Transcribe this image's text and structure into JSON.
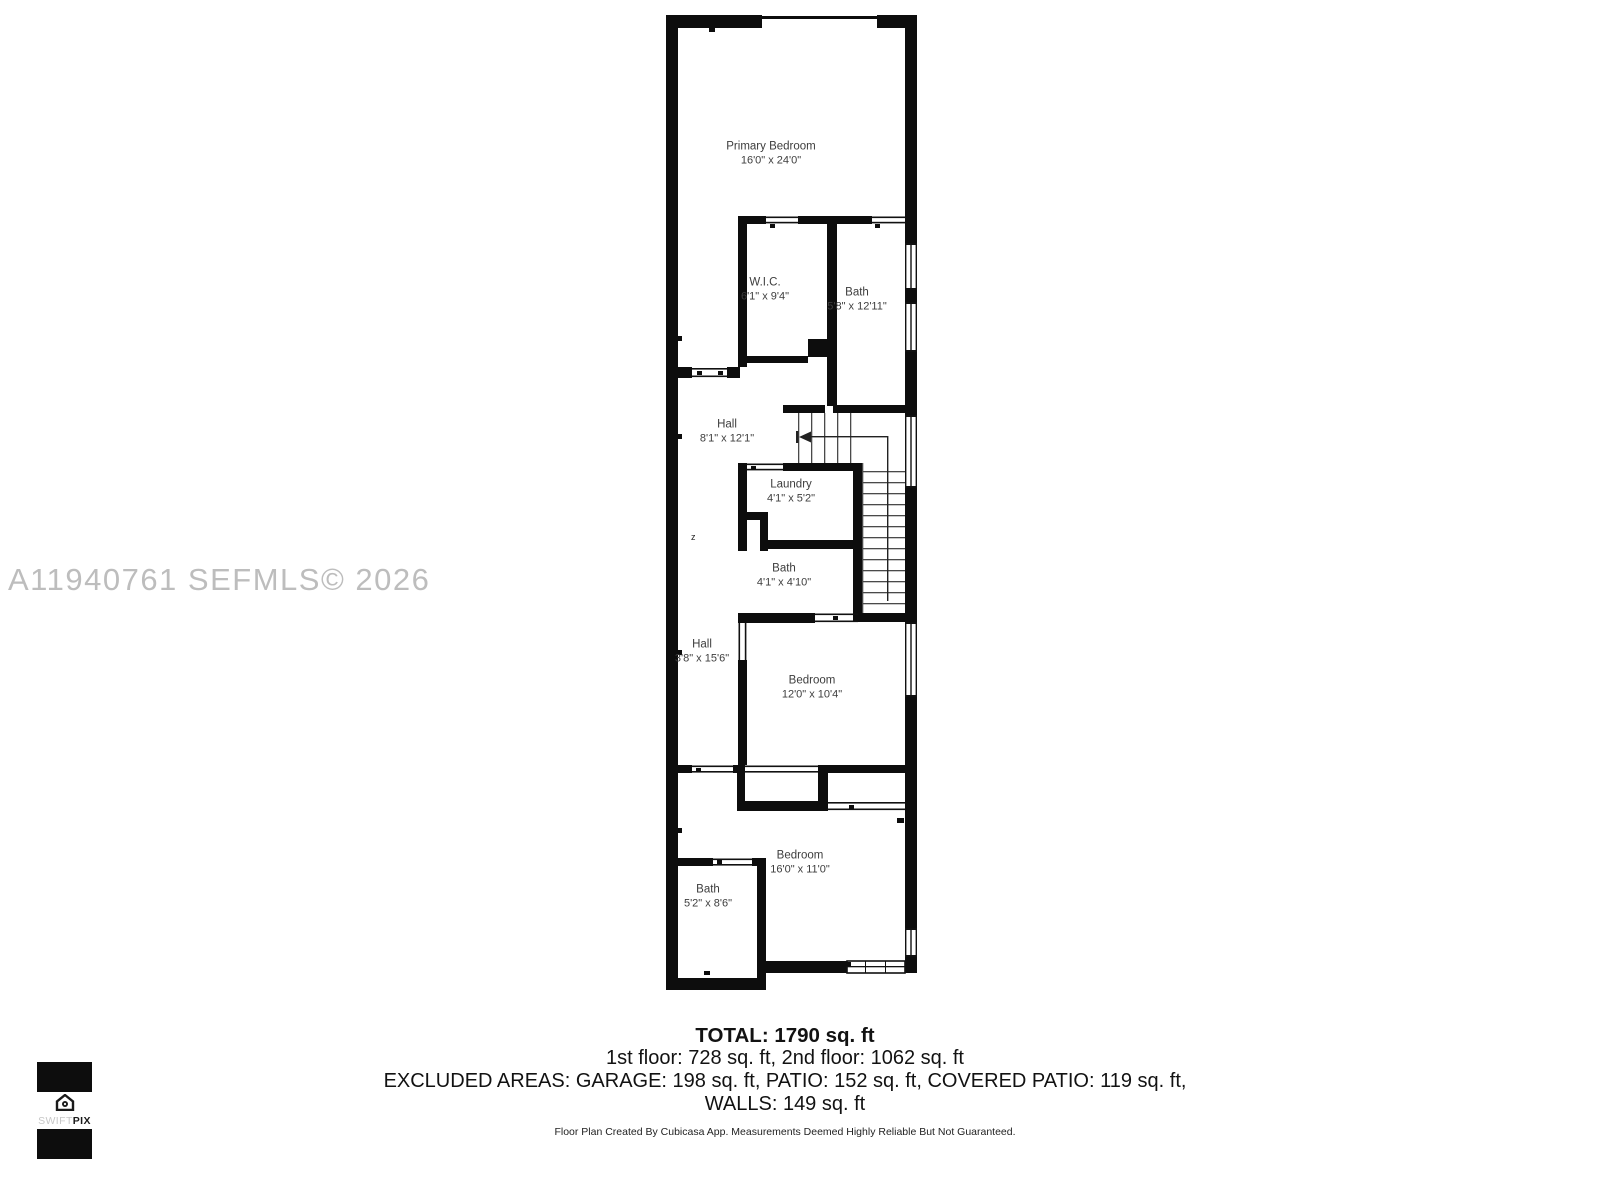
{
  "watermark": "A11940761  SEFMLS© 2026",
  "floor_plan": {
    "rooms": [
      {
        "name": "Primary Bedroom",
        "dims": "16'0\" x 24'0\""
      },
      {
        "name": "W.I.C.",
        "dims": "6'1\" x 9'4\""
      },
      {
        "name": "Bath",
        "dims": "5'8\" x 12'11\""
      },
      {
        "name": "Hall",
        "dims": "8'1\" x 12'1\""
      },
      {
        "name": "Laundry",
        "dims": "4'1\" x 5'2\""
      },
      {
        "name": "Bath",
        "dims": "4'1\" x 4'10\""
      },
      {
        "name": "Hall",
        "dims": "3'8\" x 15'6\""
      },
      {
        "name": "Bedroom",
        "dims": "12'0\" x 10'4\""
      },
      {
        "name": "Bedroom",
        "dims": "16'0\" x 11'0\""
      },
      {
        "name": "Bath",
        "dims": "5'2\" x 8'6\""
      }
    ],
    "stair_note": "z"
  },
  "summary": {
    "total": "TOTAL: 1790 sq. ft",
    "floors": "1st floor: 728 sq. ft, 2nd floor: 1062 sq. ft",
    "excluded": "EXCLUDED AREAS: GARAGE: 198 sq. ft, PATIO: 152 sq. ft, COVERED PATIO: 119 sq. ft,",
    "walls": "WALLS: 149 sq. ft",
    "disclaimer": "Floor Plan Created By Cubicasa App. Measurements Deemed Highly Reliable But Not Guaranteed."
  },
  "logo": {
    "swift": "SWIFT",
    "pix": "PIX"
  },
  "colors": {
    "wall": "#0d0d0d",
    "label": "#3d3d3d",
    "watermark": "#bdbdbd"
  }
}
